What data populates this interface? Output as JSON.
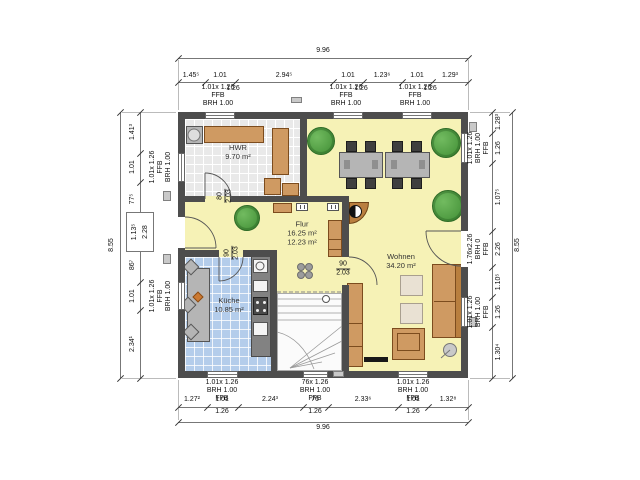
{
  "drawing": {
    "rooms": {
      "hwr": {
        "name": "HWR",
        "area": "9.70 m²"
      },
      "flur": {
        "name": "Flur",
        "area": "16.25 m²",
        "area2": "12.23 m²"
      },
      "kueche": {
        "name": "Küche",
        "area": "10.85 m²"
      },
      "wohnen": {
        "name": "Wohnen",
        "area": "34.20 m²"
      }
    },
    "doors": {
      "hwr": {
        "width": "80",
        "height": "2.03"
      },
      "kueche": {
        "width": "90",
        "height": "2.03"
      },
      "wohnen": {
        "width": "90",
        "height": "2.03"
      },
      "entrance": {
        "width": "1.13⁵",
        "height": "2.28"
      }
    },
    "openings": {
      "win_small": {
        "size": "1.01x 1.26",
        "ffb": "FFB",
        "brh": "BRH 1.00"
      },
      "win_stairs": {
        "size": "76x 1.26",
        "ffb": "FFB",
        "brh": "BRH 1.00"
      },
      "door_terrace": {
        "size": "1.76x2.26",
        "ffb": "FFB",
        "brh": "BRH 0"
      }
    },
    "dims": {
      "top": {
        "total": "9.96",
        "chain": [
          "1.45⁵",
          "1.01",
          "2.94⁵",
          "1.01",
          "1.23⁶",
          "1.01",
          "1.29³"
        ],
        "sub": [
          "1.26",
          "1.26",
          "1.26"
        ]
      },
      "bottom": {
        "total": "9.96",
        "chain": [
          "1.27²",
          "1.01",
          "2.24³",
          "76",
          "2.33⁶",
          "1.01",
          "1.32⁸"
        ],
        "sub": [
          "1.26",
          "1.26",
          "1.26"
        ]
      },
      "left": {
        "total": "8.55",
        "chain": [
          "1.41³",
          "1.01",
          "77⁵",
          "86⁷",
          "1.01",
          "2.34¹"
        ]
      },
      "right": {
        "total": "8.55",
        "chain": [
          "1.28³",
          "1.26",
          "1.07⁵",
          "2.26",
          "1.10⁵",
          "1.26",
          "1.30⁴"
        ]
      }
    },
    "colors": {
      "wall": "#4d4d4d",
      "floor_living": "#f6f2b6",
      "floor_kitchen": "#b4cdeb",
      "floor_utility": "#e9e9e9",
      "furniture_wood": "#cf9a62",
      "plant_green": "#3e8c33",
      "dining_gray": "#b5b5b5"
    },
    "symbols": [
      "plant-icon",
      "wood-stove-icon",
      "flower-icon",
      "radiator-icon",
      "vent-icon",
      "stairs-icon",
      "door-swing-icon"
    ]
  }
}
